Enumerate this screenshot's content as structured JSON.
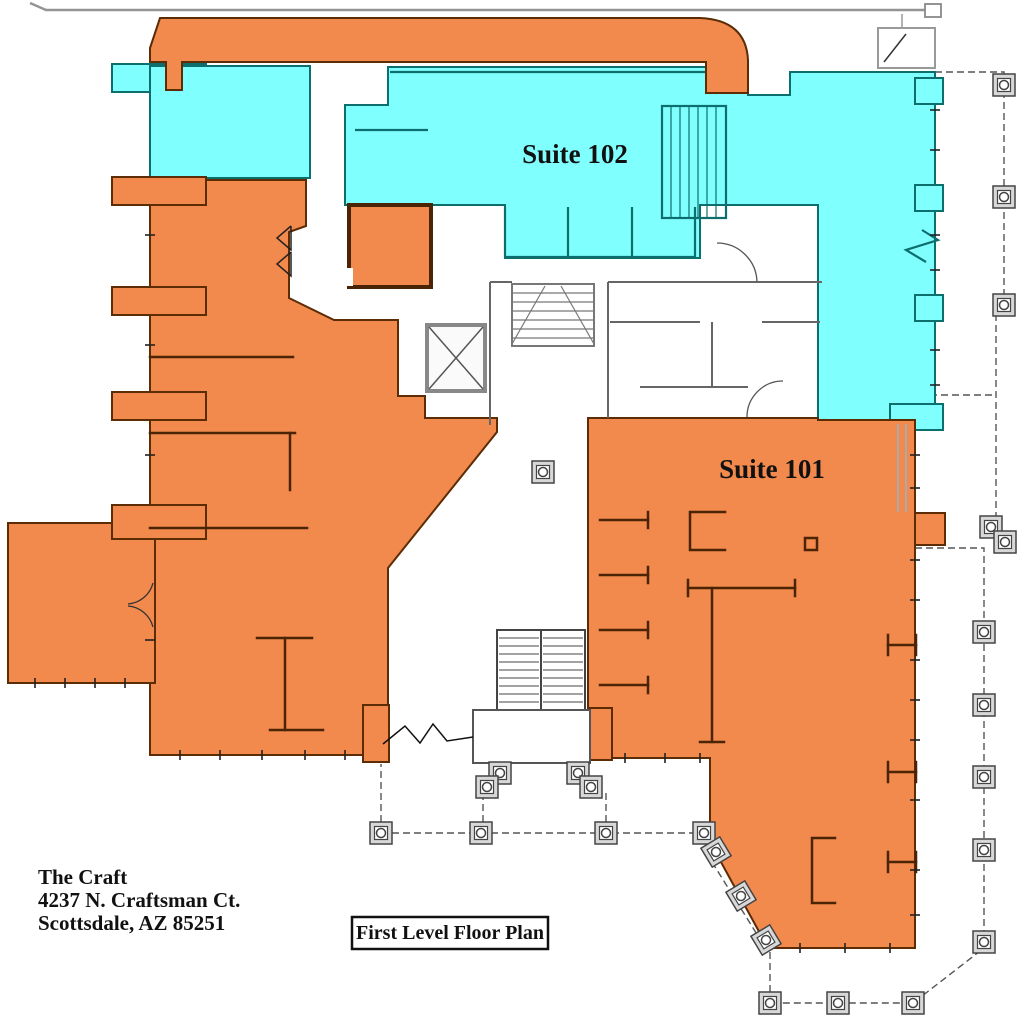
{
  "title": "First Level Floor Plan",
  "building": {
    "name": "The Craft",
    "address_line1": "4237 N. Craftsman Ct.",
    "address_line2": "Scottsdale, AZ  85251"
  },
  "suites": [
    {
      "id": "102",
      "label": "Suite 102",
      "color": "#80FFFF"
    },
    {
      "id": "101",
      "label": "Suite 101",
      "color": "#F2894D"
    }
  ],
  "colors": {
    "suite102": "#80FFFF",
    "suite101": "#F2894D",
    "wall_orange": "#5c2c05",
    "wall_teal": "#0d6e6e",
    "core_gray": "#666666",
    "marker_gray": "#d8d8d8"
  }
}
